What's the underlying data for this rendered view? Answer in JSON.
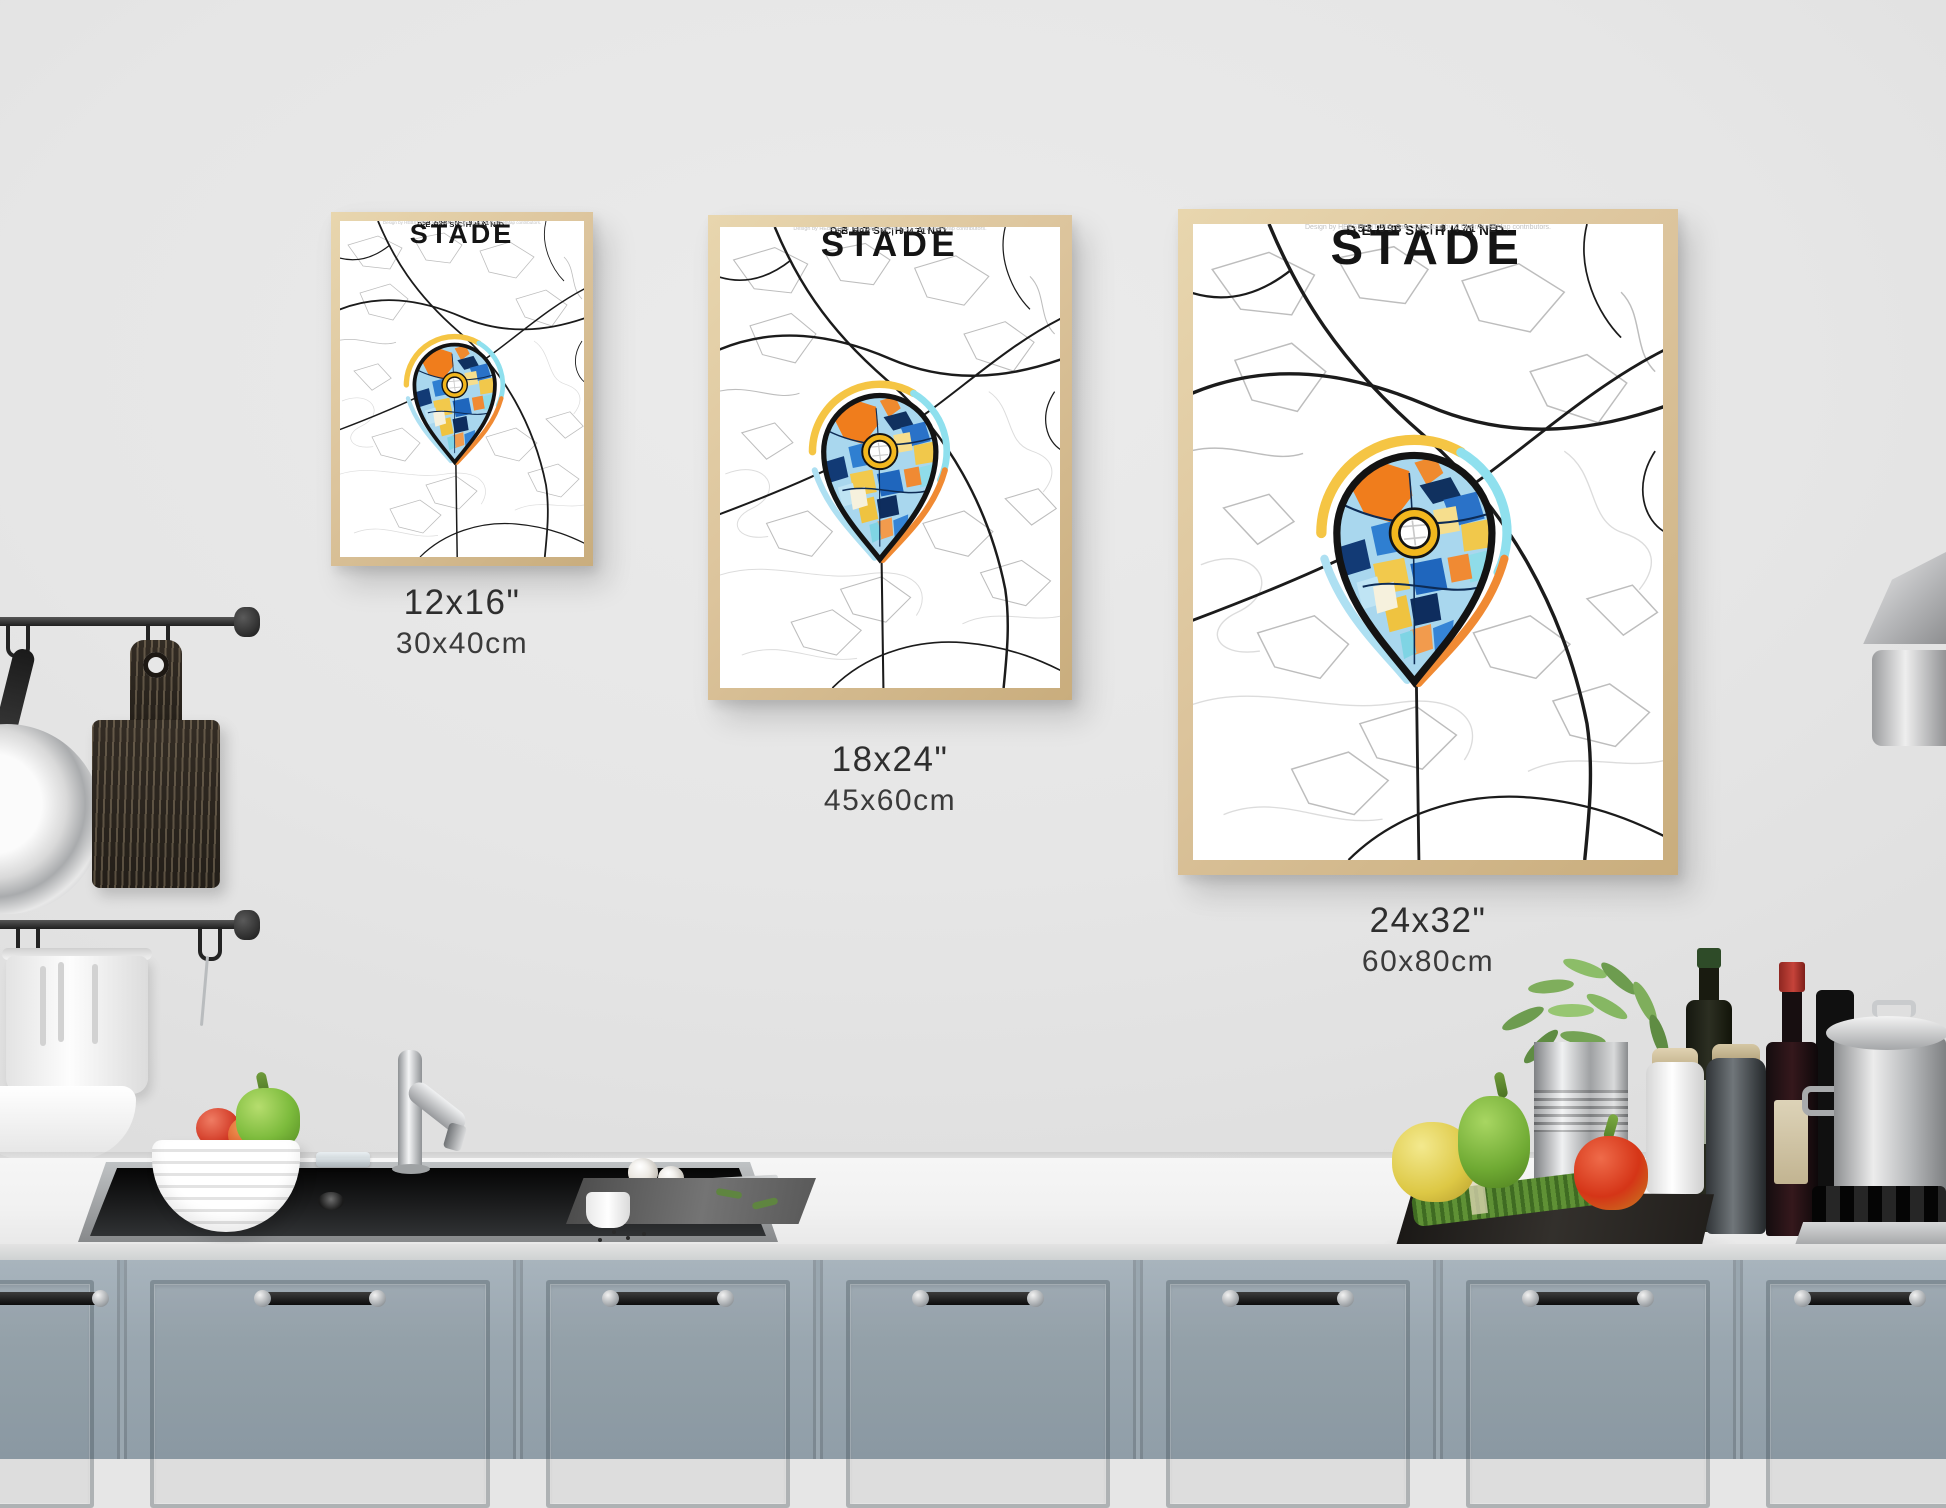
{
  "poster": {
    "title": "STADE",
    "subtitle": "DEUTSCHLAND",
    "coordinates": "53,593° N | 9,471° E",
    "attribution": "Design by HEBSTREIT. Map data supported by © OpenStreetMap contributors."
  },
  "sizes": [
    {
      "inches": "12x16\"",
      "cm": "30x40cm"
    },
    {
      "inches": "18x24\"",
      "cm": "45x60cm"
    },
    {
      "inches": "24x32\"",
      "cm": "60x80cm"
    }
  ],
  "palette": {
    "wall": "#e6e6e6",
    "cabinet_blue_gray": "#9aa7b0",
    "counter_white": "#f4f4f4",
    "wood_frame": "#dcc49c",
    "pin_gold": "#f2b71e",
    "pin_yellow": "#f2c94c",
    "pin_orange": "#f07d1c",
    "pin_blue": "#2f7fd1",
    "pin_navy": "#11315f",
    "pin_lightblue": "#a9d7ee",
    "pin_cyan": "#8fe0ee",
    "map_road_black": "#1b1b1b",
    "map_road_gray": "#bdbdbd"
  }
}
